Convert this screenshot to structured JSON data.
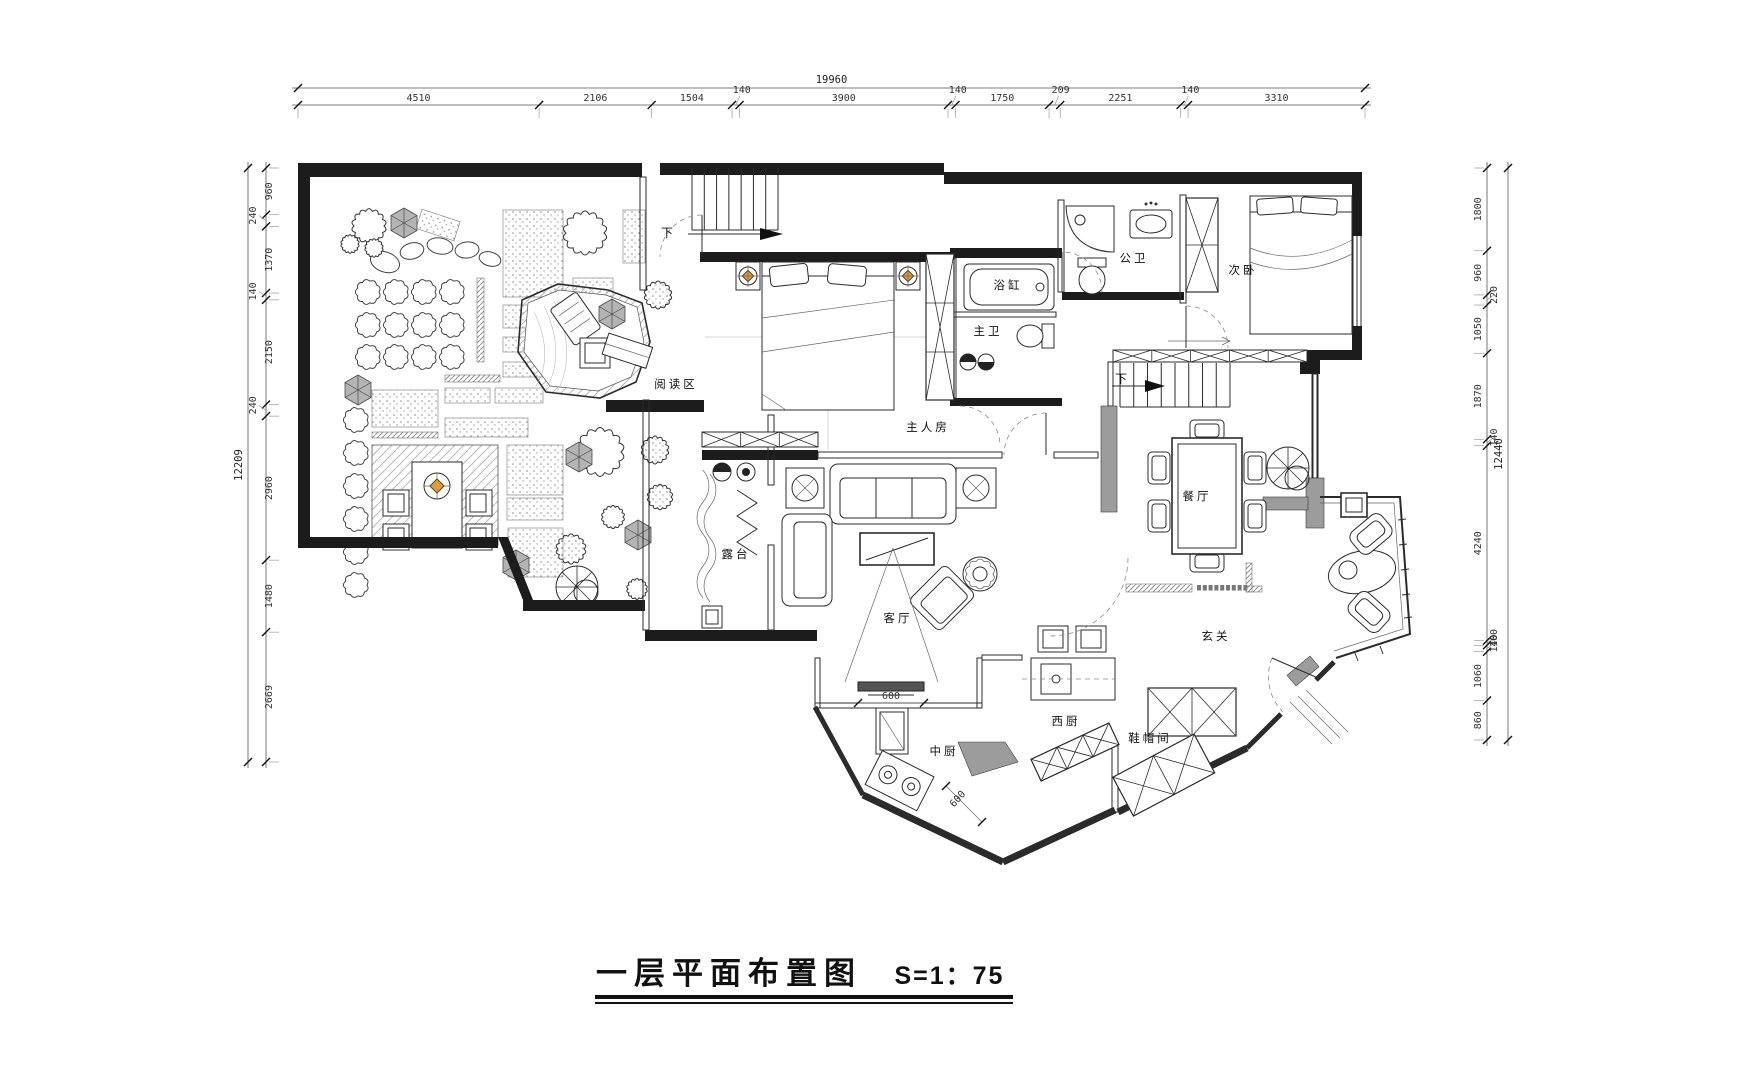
{
  "title": {
    "name": "一层平面布置图",
    "scale": "S=1：75"
  },
  "dim_chains": {
    "top": {
      "total": "19960",
      "segments": [
        "4510",
        "2106",
        "1504",
        "140",
        "3900",
        "140",
        "1750",
        "209",
        "2251",
        "140",
        "3310"
      ]
    },
    "left": {
      "total": "12209",
      "segments": [
        "960",
        "240",
        "1370",
        "140",
        "2150",
        "240",
        "2960",
        "1480",
        "2669"
      ]
    },
    "right": {
      "total": "12440",
      "segments": [
        "1800",
        "960",
        "220",
        "1050",
        "1870",
        "140",
        "4240",
        "100",
        "140",
        "1060",
        "860"
      ]
    }
  },
  "rooms": [
    {
      "id": "reading-area",
      "label": "阅读区",
      "x": 676,
      "y": 388
    },
    {
      "id": "master-bedroom",
      "label": "主人房",
      "x": 928,
      "y": 431
    },
    {
      "id": "bathtub-room",
      "label": "浴缸",
      "x": 1008,
      "y": 289
    },
    {
      "id": "master-bath",
      "label": "主卫",
      "x": 988,
      "y": 335
    },
    {
      "id": "public-bath",
      "label": "公卫",
      "x": 1134,
      "y": 262
    },
    {
      "id": "second-bedroom",
      "label": "次卧",
      "x": 1243,
      "y": 274
    },
    {
      "id": "dining-room",
      "label": "餐厅",
      "x": 1197,
      "y": 500
    },
    {
      "id": "terrace",
      "label": "露台",
      "x": 736,
      "y": 558
    },
    {
      "id": "living-room",
      "label": "客厅",
      "x": 898,
      "y": 622
    },
    {
      "id": "foyer",
      "label": "玄关",
      "x": 1216,
      "y": 640
    },
    {
      "id": "chinese-kitchen",
      "label": "中厨",
      "x": 944,
      "y": 755
    },
    {
      "id": "western-kitchen",
      "label": "西厨",
      "x": 1066,
      "y": 725
    },
    {
      "id": "cloakroom",
      "label": "鞋帽间",
      "x": 1150,
      "y": 742
    }
  ],
  "annotations": [
    {
      "id": "stair-down-top",
      "text": "下",
      "x": 667,
      "y": 237
    },
    {
      "id": "stair-down-dining",
      "text": "下",
      "x": 1121,
      "y": 383
    }
  ],
  "inline_dims": [
    {
      "id": "tv-width",
      "text": "600",
      "x": 891,
      "y": 699,
      "rotate": 0
    },
    {
      "id": "counter-width",
      "text": "600",
      "x": 960,
      "y": 801,
      "rotate": -48
    }
  ],
  "colors": {
    "line": "#2b2b2b",
    "wall": "#1c1c1c",
    "gray_wall": "#9c9c9c",
    "accent_orange": "#dd9f3e",
    "dim_text": "#333333"
  }
}
